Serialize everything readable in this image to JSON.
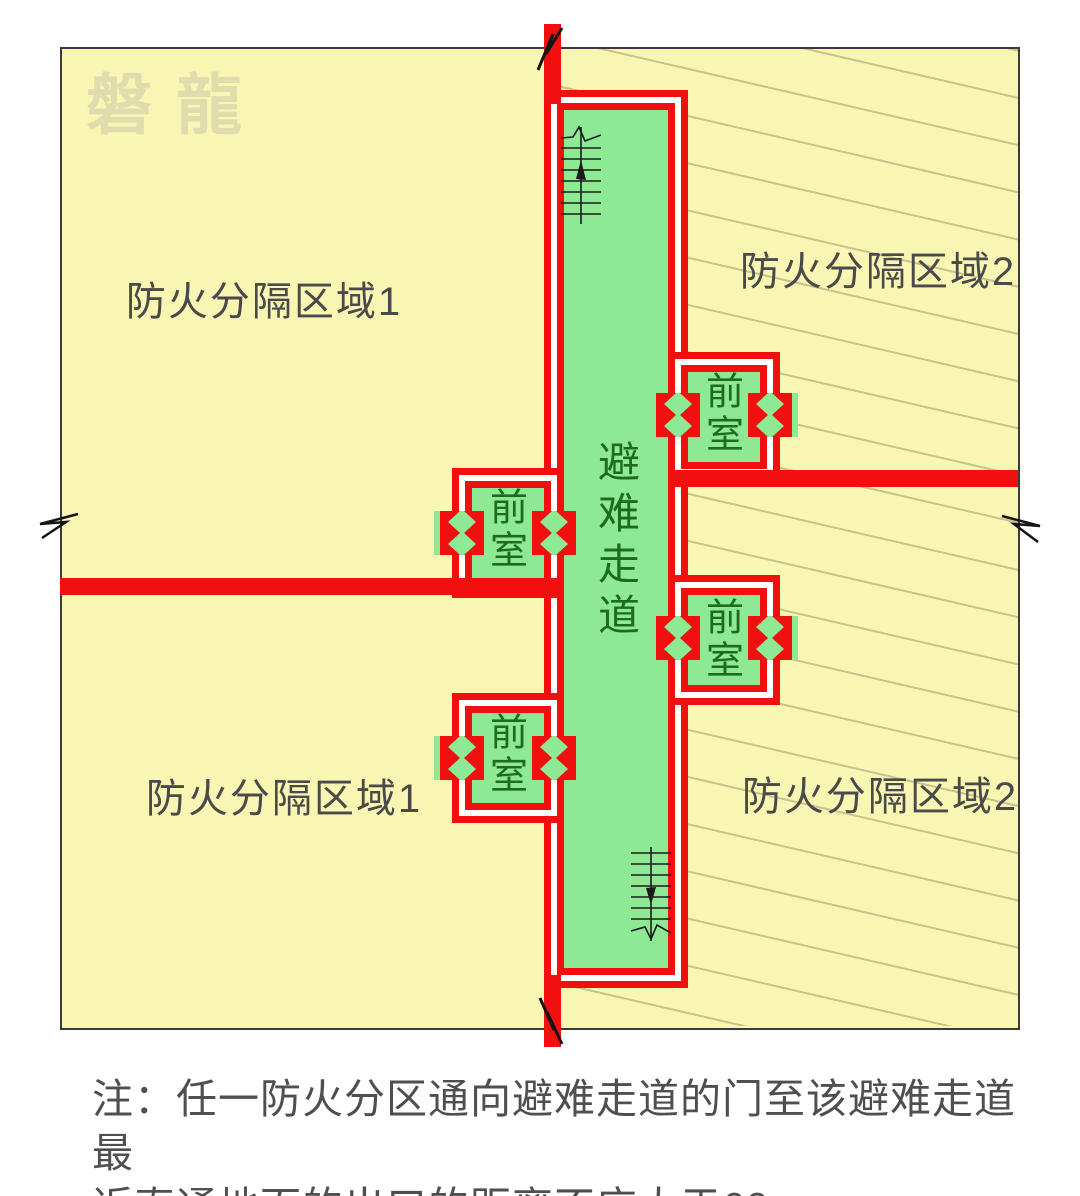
{
  "watermark": "磐龍",
  "labels": {
    "zone1_top": "防火分隔区域1",
    "zone2_top": "防火分隔区域2",
    "zone1_bottom": "防火分隔区域1",
    "zone2_bottom": "防火分隔区域2",
    "corridor": "避难走道",
    "vestibule": "前室"
  },
  "note": {
    "line1": "注：任一防火分区通向避难走道的门至该避难走道最",
    "line2": "近直通地面的出口的距离不应大于60m",
    "full": "注：任一防火分区通向避难走道的门至该避难走道最近直通地面的出口的距离不应大于60m"
  },
  "colors": {
    "wall_red": "#F10F0F",
    "safe_green": "#8DE993",
    "zone_yellow": "#F9F6B4",
    "hatch_line": "#C9C28C",
    "label_green": "#1E6B1E",
    "label_gray": "#4A4A4A"
  }
}
